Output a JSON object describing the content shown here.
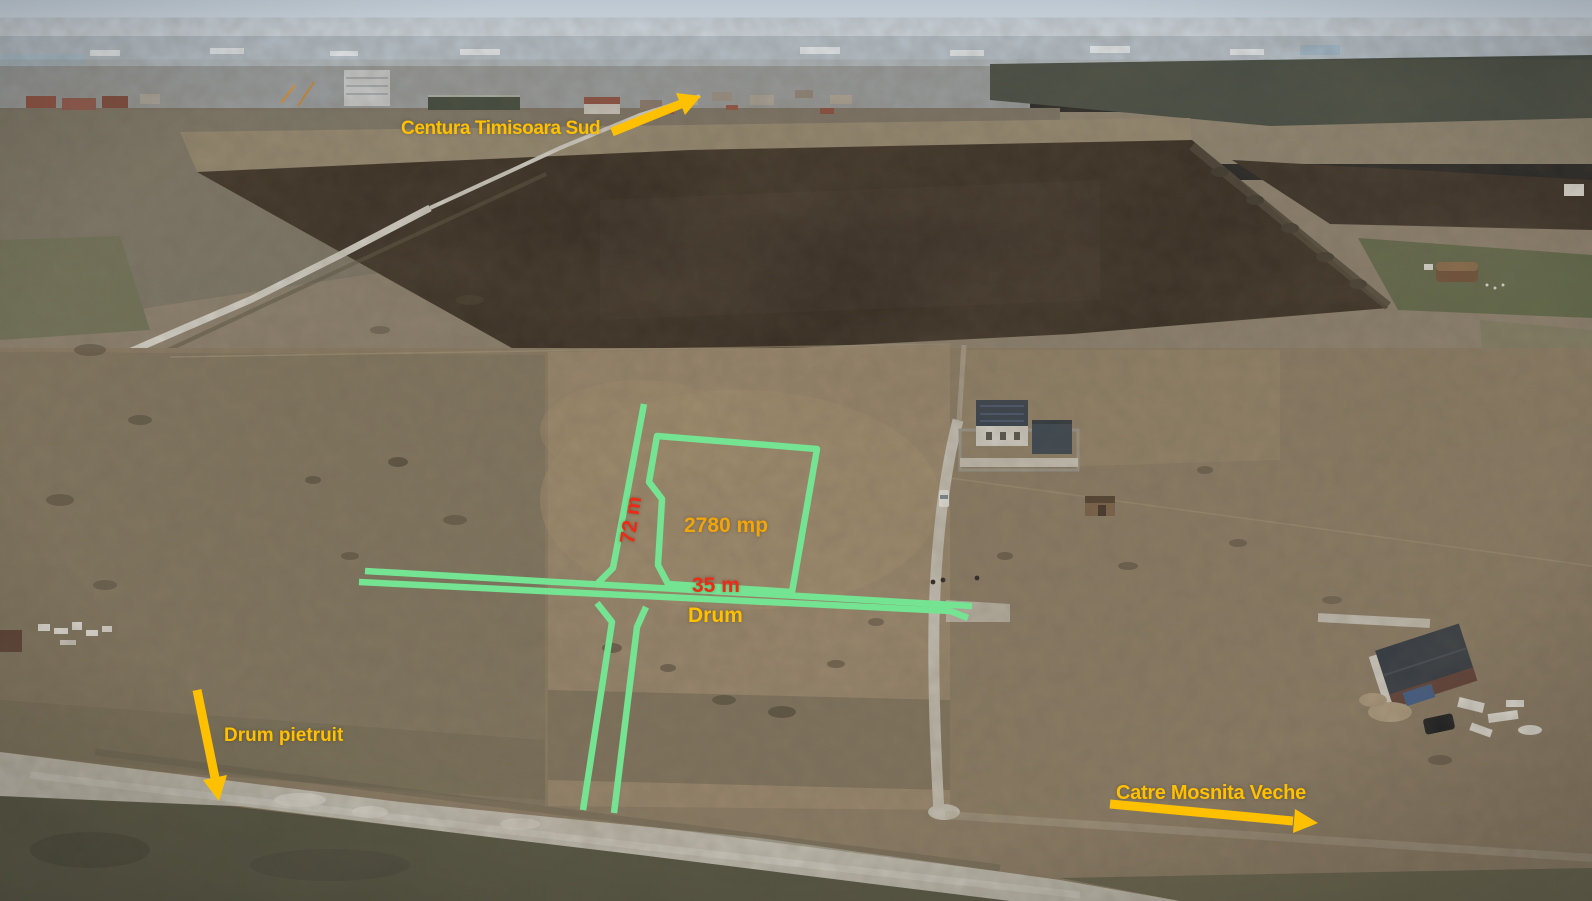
{
  "annotations": {
    "plot": {
      "area": "2780 mp",
      "frontage": "35 m",
      "depth": "72 m",
      "outline_color": "#74E392"
    },
    "roads": {
      "road_label": "Drum",
      "gravel_road_label": "Drum pietruit"
    },
    "directions": {
      "bypass": "Centura Timisoara Sud",
      "village": "Catre Mosnita Veche"
    },
    "arrows": [
      {
        "name": "arrow-to-centura",
        "direction": "up-right",
        "color": "#FFC000"
      },
      {
        "name": "arrow-to-gravel-road",
        "direction": "down",
        "color": "#FFC000"
      },
      {
        "name": "arrow-to-mosnita-veche",
        "direction": "right",
        "color": "#FFC000"
      }
    ],
    "colors": {
      "highlight_green": "#74E392",
      "label_yellow": "#FFC000",
      "label_orange": "#F2A50A",
      "label_red": "#EE2A17"
    }
  }
}
